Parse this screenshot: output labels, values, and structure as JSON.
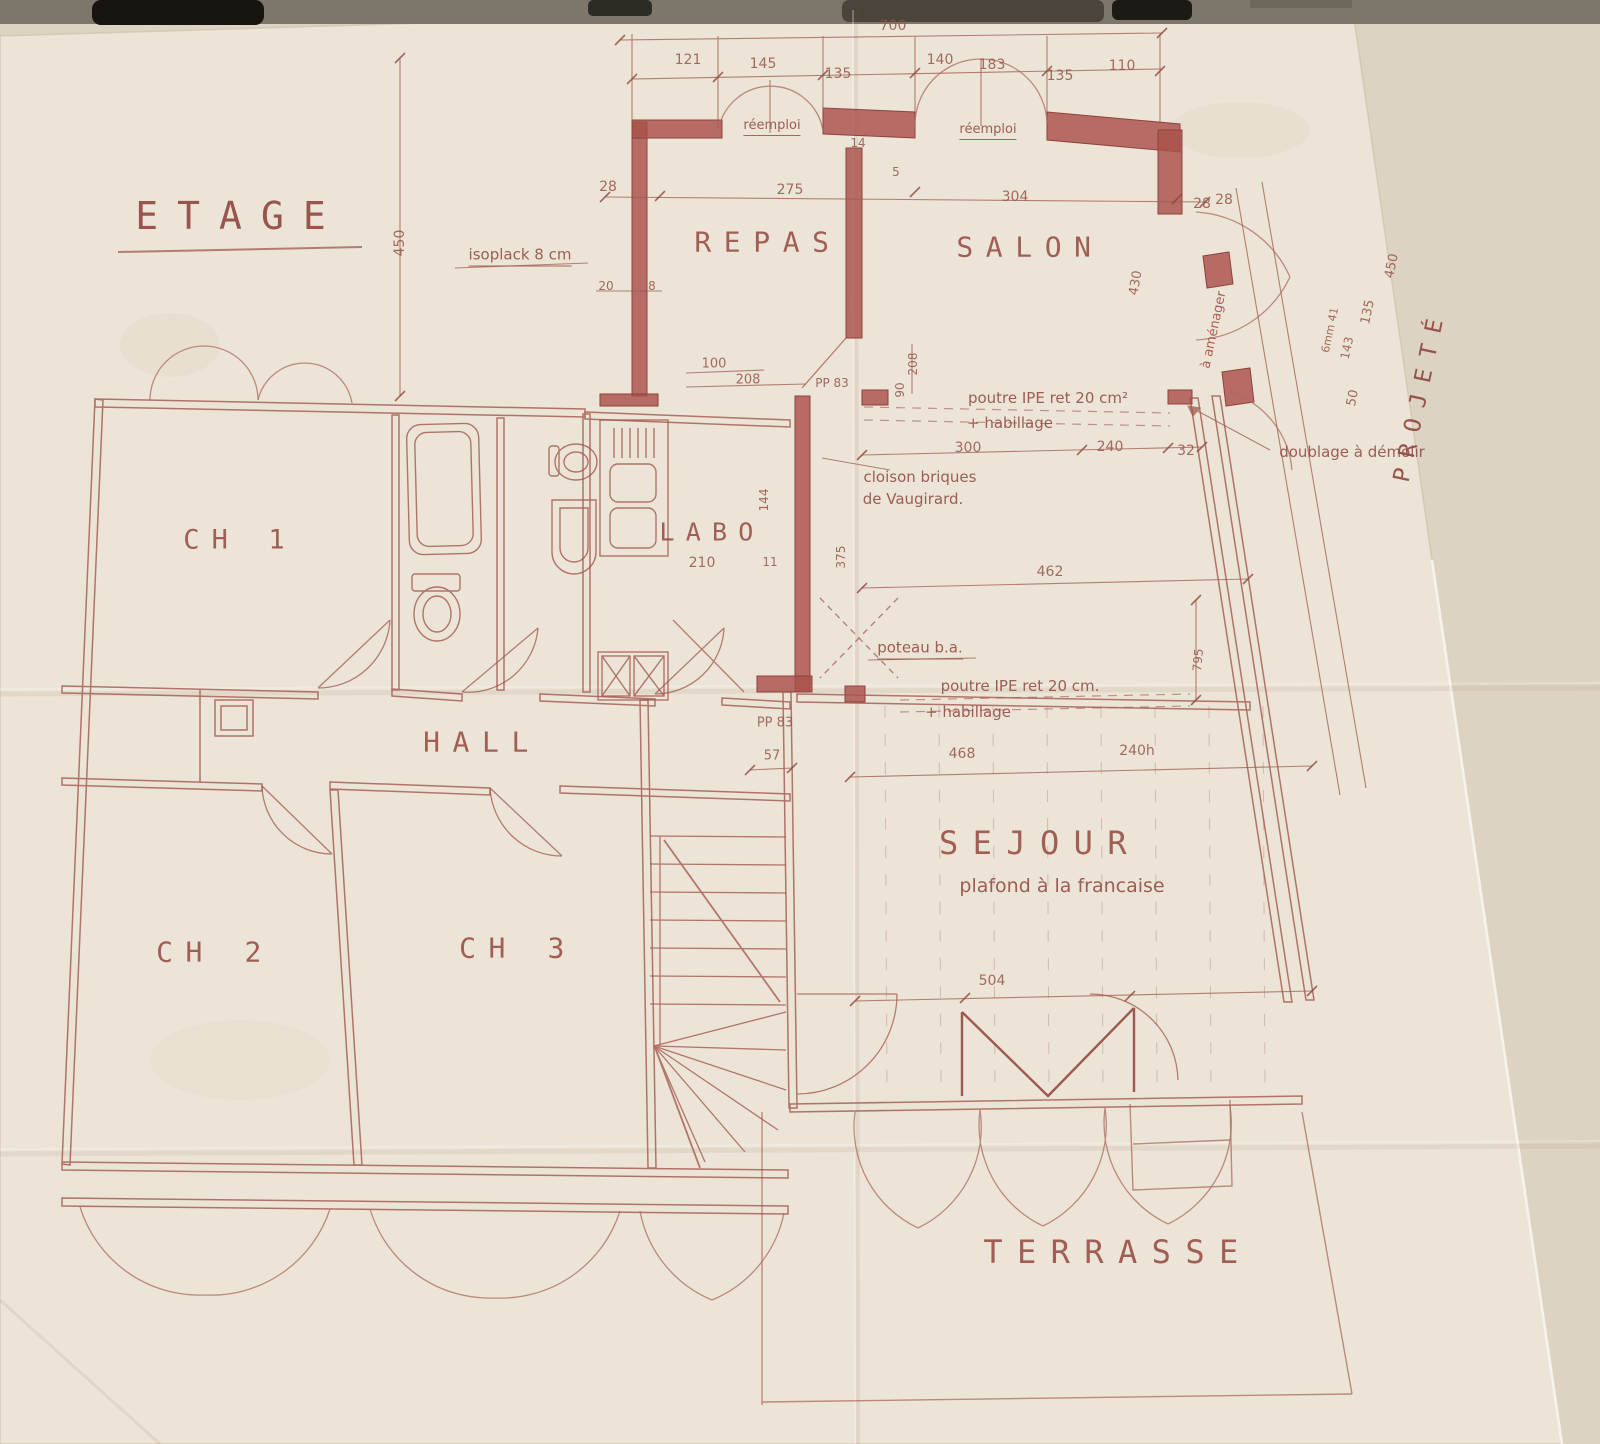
{
  "photo": {
    "paper_color": "#ece4d6",
    "backing_color": "#ded4c4",
    "ink_color": "#9c4f46",
    "wall_color": "#aa524c",
    "accent_red": "#a4453e"
  },
  "plan": {
    "title": {
      "name": "plan-title",
      "text": "ETAGE",
      "x": 240,
      "y": 216,
      "size": 38,
      "cls": "title"
    },
    "rooms": [
      {
        "name": "room-repas",
        "text": "REPAS",
        "x": 768,
        "y": 242,
        "size": 28
      },
      {
        "name": "room-salon",
        "text": "SALON",
        "x": 1030,
        "y": 247,
        "size": 28
      },
      {
        "name": "room-ch1",
        "text": "CH 1",
        "x": 240,
        "y": 540,
        "size": 27
      },
      {
        "name": "room-labo",
        "text": "LABO",
        "x": 712,
        "y": 532,
        "size": 25
      },
      {
        "name": "room-hall",
        "text": "HALL",
        "x": 482,
        "y": 742,
        "size": 28
      },
      {
        "name": "room-ch2",
        "text": "CH 2",
        "x": 215,
        "y": 952,
        "size": 28
      },
      {
        "name": "room-ch3",
        "text": "CH 3",
        "x": 518,
        "y": 948,
        "size": 28
      },
      {
        "name": "room-sejour",
        "text": "SEJOUR",
        "x": 1040,
        "y": 843,
        "size": 32
      },
      {
        "name": "room-terrasse",
        "text": "TERRASSE",
        "x": 1118,
        "y": 1252,
        "size": 32
      }
    ],
    "notes": [
      {
        "name": "note-isoplack",
        "text": "isoplack  8 cm",
        "x": 520,
        "y": 256,
        "u": 1
      },
      {
        "name": "note-reemploi-1",
        "text": "réemploi",
        "x": 772,
        "y": 127,
        "size": 13,
        "u": 1
      },
      {
        "name": "note-reemploi-2",
        "text": "réemploi",
        "x": 988,
        "y": 131,
        "size": 13,
        "u": 1
      },
      {
        "name": "note-poutre-1",
        "text": "poutre IPE ret 20 cm²",
        "x": 1048,
        "y": 398
      },
      {
        "name": "note-habillage-1",
        "text": "+ habillage",
        "x": 1010,
        "y": 423
      },
      {
        "name": "note-doublage",
        "text": "doublage à démolir",
        "x": 1352,
        "y": 452
      },
      {
        "name": "note-cloison-1",
        "text": "cloison briques",
        "x": 920,
        "y": 477
      },
      {
        "name": "note-cloison-2",
        "text": "de Vaugirard.",
        "x": 913,
        "y": 499
      },
      {
        "name": "note-amenager",
        "text": "à aménager",
        "x": 1214,
        "y": 330,
        "rot": -78,
        "size": 13,
        "color": "#a4453e"
      },
      {
        "name": "note-poteau",
        "text": "poteau b.a.",
        "x": 920,
        "y": 649,
        "u": 1
      },
      {
        "name": "note-poutre-2",
        "text": "poutre IPE ret 20 cm.",
        "x": 1020,
        "y": 686
      },
      {
        "name": "note-habillage-2",
        "text": "+ habillage",
        "x": 968,
        "y": 712
      },
      {
        "name": "note-plafond",
        "text": "plafond à la francaise",
        "x": 1062,
        "y": 886,
        "size": 19
      },
      {
        "name": "note-projete",
        "text": "PROJETÉ",
        "x": 1420,
        "y": 395,
        "rot": -78,
        "size": 23,
        "cls": "title"
      }
    ],
    "dims": [
      {
        "name": "dim-700",
        "text": "700",
        "x": 893,
        "y": 26
      },
      {
        "name": "dim-121",
        "text": "121",
        "x": 688,
        "y": 60
      },
      {
        "name": "dim-145",
        "text": "145",
        "x": 763,
        "y": 64
      },
      {
        "name": "dim-135a",
        "text": "135",
        "x": 838,
        "y": 74
      },
      {
        "name": "dim-140",
        "text": "140",
        "x": 940,
        "y": 60
      },
      {
        "name": "dim-183",
        "text": "183",
        "x": 992,
        "y": 65
      },
      {
        "name": "dim-135b",
        "text": "135",
        "x": 1060,
        "y": 76
      },
      {
        "name": "dim-110",
        "text": "110",
        "x": 1122,
        "y": 66
      },
      {
        "name": "dim-14",
        "text": "14",
        "x": 858,
        "y": 143,
        "size": 12
      },
      {
        "name": "dim-5",
        "text": "5",
        "x": 896,
        "y": 172,
        "size": 12
      },
      {
        "name": "dim-28a",
        "text": "28",
        "x": 608,
        "y": 187
      },
      {
        "name": "dim-275",
        "text": "275",
        "x": 790,
        "y": 190
      },
      {
        "name": "dim-304",
        "text": "304",
        "x": 1015,
        "y": 197
      },
      {
        "name": "dim-28b",
        "text": "28",
        "x": 1202,
        "y": 204
      },
      {
        "name": "dim-450L",
        "text": "450",
        "x": 400,
        "y": 243,
        "rot": -90
      },
      {
        "name": "dim-20",
        "text": "20",
        "x": 606,
        "y": 286,
        "size": 12
      },
      {
        "name": "dim-8",
        "text": "8",
        "x": 652,
        "y": 286,
        "size": 12
      },
      {
        "name": "dim-100",
        "text": "100",
        "x": 714,
        "y": 364,
        "size": 13
      },
      {
        "name": "dim-208a",
        "text": "208",
        "x": 748,
        "y": 380,
        "size": 13
      },
      {
        "name": "dim-pp83a",
        "text": "PP 83",
        "x": 832,
        "y": 383,
        "size": 12
      },
      {
        "name": "dim-208b",
        "text": "208",
        "x": 913,
        "y": 364,
        "rot": -90,
        "size": 12
      },
      {
        "name": "dim-90",
        "text": "90",
        "x": 900,
        "y": 390,
        "rot": -90,
        "size": 12
      },
      {
        "name": "dim-300",
        "text": "300",
        "x": 968,
        "y": 448
      },
      {
        "name": "dim-240",
        "text": "240",
        "x": 1110,
        "y": 447
      },
      {
        "name": "dim-32",
        "text": "32",
        "x": 1186,
        "y": 451
      },
      {
        "name": "dim-430",
        "text": "430",
        "x": 1136,
        "y": 283,
        "rot": -80,
        "size": 13
      },
      {
        "name": "dim-28c",
        "text": "28",
        "x": 1224,
        "y": 200
      },
      {
        "name": "dim-450R",
        "text": "450",
        "x": 1392,
        "y": 266,
        "rot": -78,
        "size": 13
      },
      {
        "name": "dim-135c",
        "text": "135",
        "x": 1368,
        "y": 312,
        "rot": -78,
        "size": 13
      },
      {
        "name": "dim-6mm41",
        "text": "6mm 41",
        "x": 1330,
        "y": 330,
        "rot": -78,
        "size": 11
      },
      {
        "name": "dim-143",
        "text": "143",
        "x": 1347,
        "y": 348,
        "rot": -78,
        "size": 12
      },
      {
        "name": "dim-50",
        "text": "50",
        "x": 1353,
        "y": 398,
        "rot": -78,
        "size": 13
      },
      {
        "name": "dim-144",
        "text": "144",
        "x": 764,
        "y": 500,
        "rot": -90,
        "size": 12
      },
      {
        "name": "dim-210",
        "text": "210",
        "x": 702,
        "y": 563
      },
      {
        "name": "dim-11",
        "text": "11",
        "x": 770,
        "y": 562,
        "size": 12
      },
      {
        "name": "dim-375",
        "text": "375",
        "x": 841,
        "y": 557,
        "rot": -90,
        "size": 12
      },
      {
        "name": "dim-462",
        "text": "462",
        "x": 1050,
        "y": 572
      },
      {
        "name": "dim-795",
        "text": "795",
        "x": 1198,
        "y": 660,
        "rot": -85,
        "size": 12
      },
      {
        "name": "dim-pp83b",
        "text": "PP 83",
        "x": 775,
        "y": 723,
        "size": 13
      },
      {
        "name": "dim-57",
        "text": "57",
        "x": 772,
        "y": 756,
        "size": 13
      },
      {
        "name": "dim-468",
        "text": "468",
        "x": 962,
        "y": 754
      },
      {
        "name": "dim-240h",
        "text": "240h",
        "x": 1137,
        "y": 751
      },
      {
        "name": "dim-504",
        "text": "504",
        "x": 992,
        "y": 981
      }
    ]
  }
}
